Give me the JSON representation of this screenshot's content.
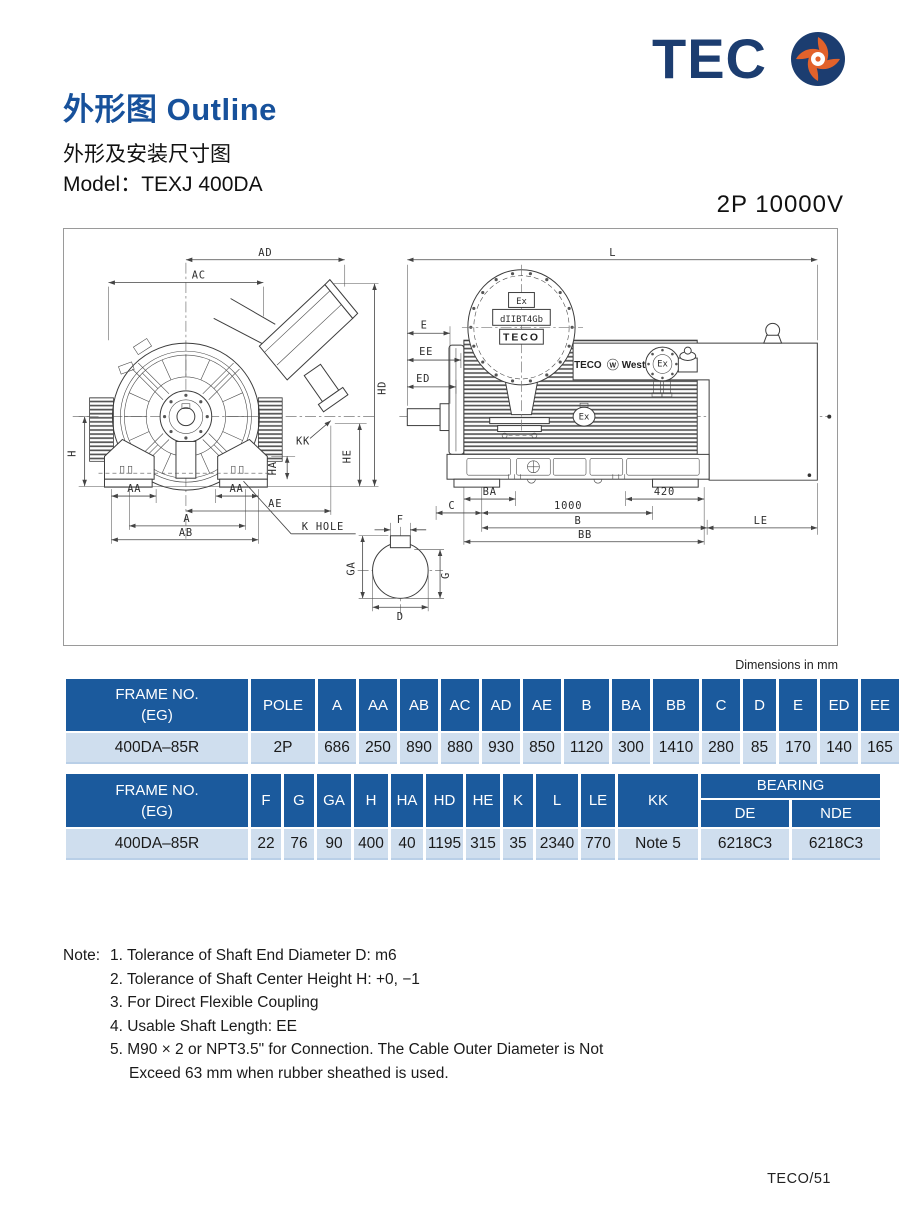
{
  "logo": {
    "text": "TEC"
  },
  "header": {
    "title_zh": "外形图",
    "title_en": "Outline",
    "subtitle": "外形及安装尺寸图",
    "model": "Model：TEXJ 400DA",
    "rating": "2P  10000V"
  },
  "drawing": {
    "dims_note": "Dimensions in mm",
    "labels": {
      "AD": "AD",
      "AC": "AC",
      "HD": "HD",
      "H": "H",
      "KK": "KK",
      "HE": "HE",
      "HA": "HA",
      "AA_L": "AA",
      "AA_R": "AA",
      "AE": "AE",
      "A": "A",
      "AB": "AB",
      "K_HOLE": "K HOLE",
      "L": "L",
      "E": "E",
      "EE": "EE",
      "ED": "ED",
      "BA": "BA",
      "D420": "420",
      "C": "C",
      "D1000": "1000",
      "B": "B",
      "LE": "LE",
      "BB": "BB",
      "F": "F",
      "GA": "GA",
      "G": "G",
      "D": "D"
    },
    "plate": {
      "ex": "Ex",
      "code": "dIIBT4Gb",
      "brand": "TECO"
    },
    "body_brand_left": "TECO",
    "body_brand_mark": "W",
    "body_brand_right": "Westinghouse",
    "device_label": "Ex",
    "ex_marker": "Ex"
  },
  "table1": {
    "frame_header": "FRAME  NO.\n(EG)",
    "pole_header": "POLE",
    "cols": [
      "A",
      "AA",
      "AB",
      "AC",
      "AD",
      "AE",
      "B",
      "BA",
      "BB",
      "C",
      "D",
      "E",
      "ED",
      "EE"
    ],
    "row": {
      "frame": "400DA–85R",
      "pole": "2P",
      "values": [
        "686",
        "250",
        "890",
        "880",
        "930",
        "850",
        "1120",
        "300",
        "1410",
        "280",
        "85",
        "170",
        "140",
        "165"
      ]
    }
  },
  "table2": {
    "frame_header": "FRAME  NO.\n(EG)",
    "cols": [
      "F",
      "G",
      "GA",
      "H",
      "HA",
      "HD",
      "HE",
      "K",
      "L",
      "LE",
      "KK"
    ],
    "bearing_header": "BEARING",
    "bearing_cols": [
      "DE",
      "NDE"
    ],
    "row": {
      "frame": "400DA–85R",
      "values": [
        "22",
        "76",
        "90",
        "400",
        "40",
        "1195",
        "315",
        "35",
        "2340",
        "770",
        "Note 5"
      ],
      "bearing": [
        "6218C3",
        "6218C3"
      ]
    }
  },
  "notes": {
    "label": "Note:",
    "items": [
      "1. Tolerance of Shaft End Diameter D: m6",
      "2. Tolerance of Shaft Center Height H: +0, −1",
      "3. For Direct Flexible Coupling",
      "4. Usable Shaft Length: EE",
      "5. M90 × 2 or NPT3.5\" for Connection. The Cable Outer Diameter is Not\nExceed 63 mm when rubber sheathed is used."
    ]
  },
  "footer": "TECO/51"
}
